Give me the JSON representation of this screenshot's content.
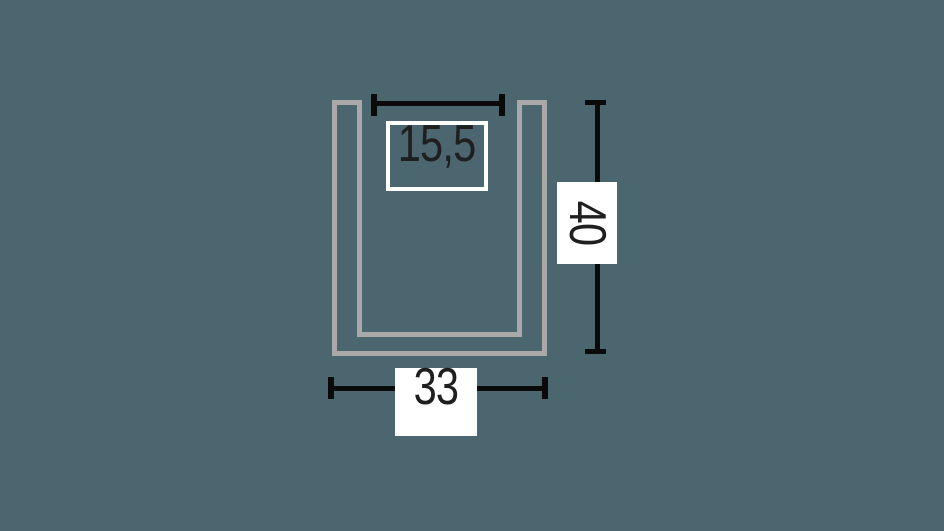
{
  "page": {
    "background_color": "#4c6670"
  },
  "diagram": {
    "title": "u-channel-profile-cross-section-with-dimensions",
    "profile_outline_color": "#a9a9a9",
    "dimension_line_color": "#0a0a0a",
    "label_background_color": "#ffffff",
    "label_border_color": "#ffffff",
    "label_text_color": "#1f1f1f",
    "dimensions": {
      "inner_width": {
        "value": "15,5",
        "orientation": "horizontal",
        "position": "top",
        "label_style": "outlined-transparent"
      },
      "height": {
        "value": "40",
        "orientation": "vertical",
        "position": "right",
        "label_style": "filled-white"
      },
      "outer_width": {
        "value": "33",
        "orientation": "horizontal",
        "position": "bottom",
        "label_style": "filled-white"
      }
    }
  }
}
